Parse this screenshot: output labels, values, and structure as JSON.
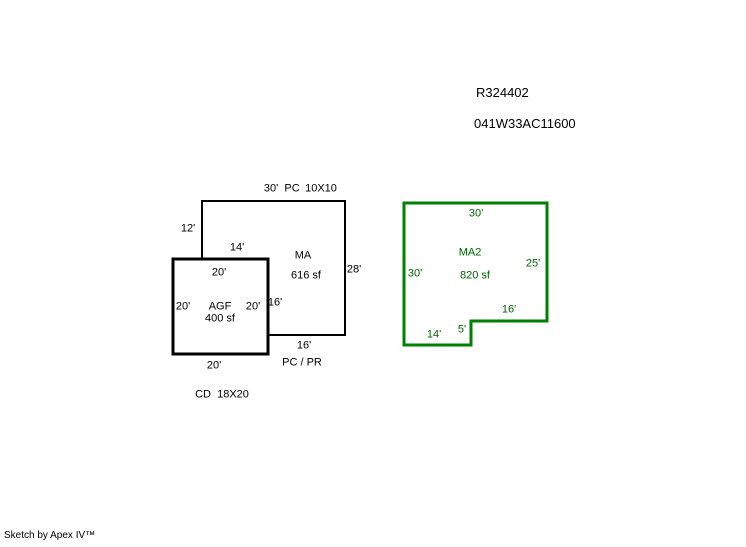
{
  "header": {
    "record_number": "R324402",
    "parcel_number": "041W33AC11600"
  },
  "areas": {
    "ma": {
      "name": "MA",
      "area": "616 sf",
      "top_dim": "30'",
      "top_code": "PC",
      "top_size": "10X10",
      "left_dim": "12'",
      "step_dim": "14'",
      "right_dim": "28'",
      "inner_dim": "16'",
      "bottom_dim": "16'",
      "bottom_code": "PC / PR"
    },
    "agf": {
      "name": "AGF",
      "area": "400 sf",
      "top_dim": "20'",
      "left_dim": "20'",
      "right_dim": "20'",
      "bottom_dim": "20'",
      "note": "CD  18X20"
    },
    "ma2": {
      "name": "MA2",
      "area": "820 sf",
      "top_dim": "30'",
      "left_dim": "30'",
      "right_dim": "25'",
      "step_dim": "16'",
      "notch_dim": "5'",
      "bottom_dim": "14'"
    }
  },
  "footer": {
    "credit": "Sketch by Apex IV™"
  },
  "colors": {
    "ink": "#000000",
    "green_line": "#008000",
    "green_text": "#006400",
    "background": "#ffffff"
  }
}
